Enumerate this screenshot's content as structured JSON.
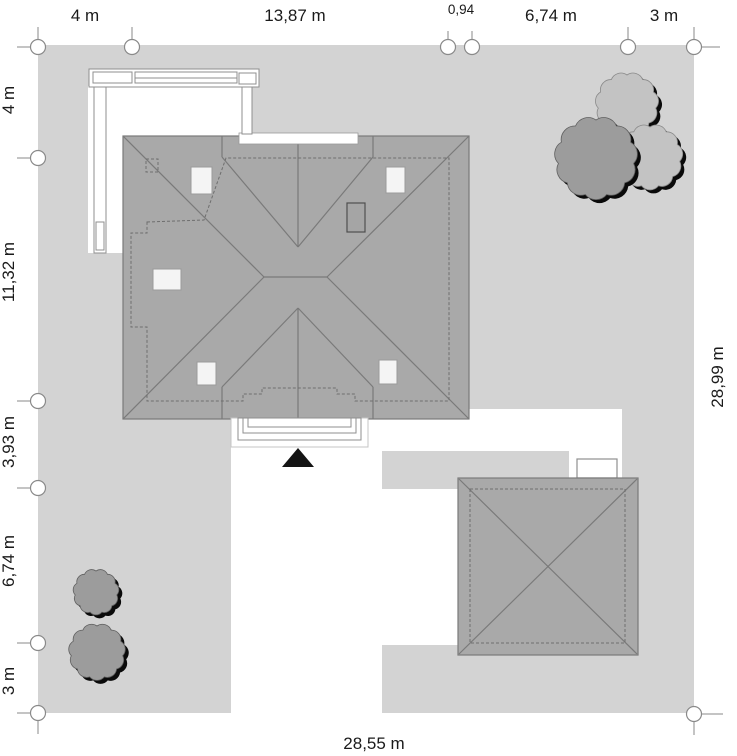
{
  "title": "site-plan",
  "dimensions": {
    "top": [
      "4 m",
      "13,87 m",
      "0,94",
      "6,74 m",
      "3 m"
    ],
    "left": [
      "4 m",
      "11,32 m",
      "3,93 m",
      "6,74 m",
      "3 m"
    ],
    "right": "28,99 m",
    "bottom": "28,55 m"
  },
  "colors": {
    "plot": "#d3d3d3",
    "roof": "#a9a9a9",
    "roof_line": "#7a7a7a",
    "dash_line": "#6e6e6e",
    "white": "#ffffff",
    "outline": "#8f8f8f",
    "light_outline": "#c4c4c4",
    "marker_stroke": "#8a8a8a",
    "tree_dark": "#9c9c9c",
    "tree_light": "#c3c3c3",
    "tree_dark_stroke": "#5f5f5f",
    "tree_light_stroke": "#8a8a8a",
    "shadow": "#0a0a0a",
    "arrow": "#141414",
    "text": "#1a1a1a"
  },
  "trees": [
    {
      "x": 627,
      "y": 104,
      "r": 29,
      "shade": "light"
    },
    {
      "x": 650,
      "y": 157,
      "r": 30,
      "shade": "light"
    },
    {
      "x": 596,
      "y": 158,
      "r": 38,
      "shade": "dark"
    },
    {
      "x": 96,
      "y": 592,
      "r": 21,
      "shade": "dark"
    },
    {
      "x": 97,
      "y": 652,
      "r": 26,
      "shade": "dark"
    }
  ]
}
